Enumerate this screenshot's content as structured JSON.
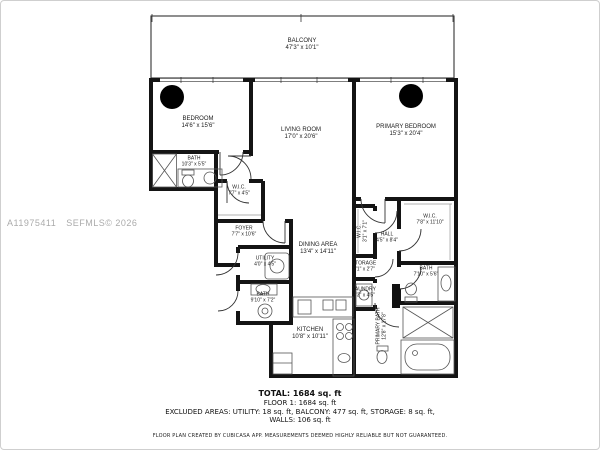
{
  "watermark": {
    "id": "A11975411",
    "source": "SEFMLS© 2026"
  },
  "rooms": [
    {
      "id": "balcony",
      "name": "BALCONY",
      "dims": "47'3\" x 10'1\""
    },
    {
      "id": "bedroom",
      "name": "BEDROOM",
      "dims": "14'6\" x 15'6\""
    },
    {
      "id": "bath",
      "name": "BATH",
      "dims": "10'3\" x 5'5\""
    },
    {
      "id": "wic",
      "name": "W.I.C.",
      "dims": "7'7\" x 4'5\""
    },
    {
      "id": "living-room",
      "name": "LIVING ROOM",
      "dims": "17'0\" x 20'6\""
    },
    {
      "id": "primary-bedroom",
      "name": "PRIMARY BEDROOM",
      "dims": "15'3\" x 20'4\""
    },
    {
      "id": "wic-primary",
      "name": "W.I.C.",
      "dims": "7'8\" x 11'10\""
    },
    {
      "id": "hall",
      "name": "HALL",
      "dims": "4'5\" x 8'4\""
    },
    {
      "id": "wic-small",
      "name": "W.I.C.",
      "dims": "3'1\" x 7'1\""
    },
    {
      "id": "bath-2",
      "name": "BATH",
      "dims": "7'10\" x 5'6\""
    },
    {
      "id": "storage",
      "name": "STORAGE",
      "dims": "3'1\" x 2'7\""
    },
    {
      "id": "laundry",
      "name": "LAUNDRY",
      "dims": "3'3\" x 4'5\""
    },
    {
      "id": "primary-bath",
      "name": "PRIMARY BATH",
      "dims": "12'8\" x 17'8\""
    },
    {
      "id": "foyer",
      "name": "FOYER",
      "dims": "7'7\" x 10'6\""
    },
    {
      "id": "utility",
      "name": "UTILITY",
      "dims": "4'0\" x 4'5\""
    },
    {
      "id": "bath-3",
      "name": "BATH",
      "dims": "9'10\" x 7'2\""
    },
    {
      "id": "dining-area",
      "name": "DINING AREA",
      "dims": "13'4\" x 14'11\""
    },
    {
      "id": "kitchen",
      "name": "KITCHEN",
      "dims": "10'8\" x 10'11\""
    }
  ],
  "summary": {
    "total": "TOTAL: 1684 sq. ft",
    "floor": "FLOOR 1: 1684 sq. ft",
    "excluded": "EXCLUDED AREAS: UTILITY: 18 sq. ft, BALCONY: 477 sq. ft, STORAGE: 8 sq. ft,",
    "walls": "WALLS: 106 sq. ft",
    "disclaimer": "FLOOR PLAN CREATED BY CUBICASA APP. MEASUREMENTS DEEMED HIGHLY RELIABLE BUT NOT GUARANTEED."
  },
  "colors": {
    "walls": "#141414",
    "watermark": "#ababab"
  }
}
